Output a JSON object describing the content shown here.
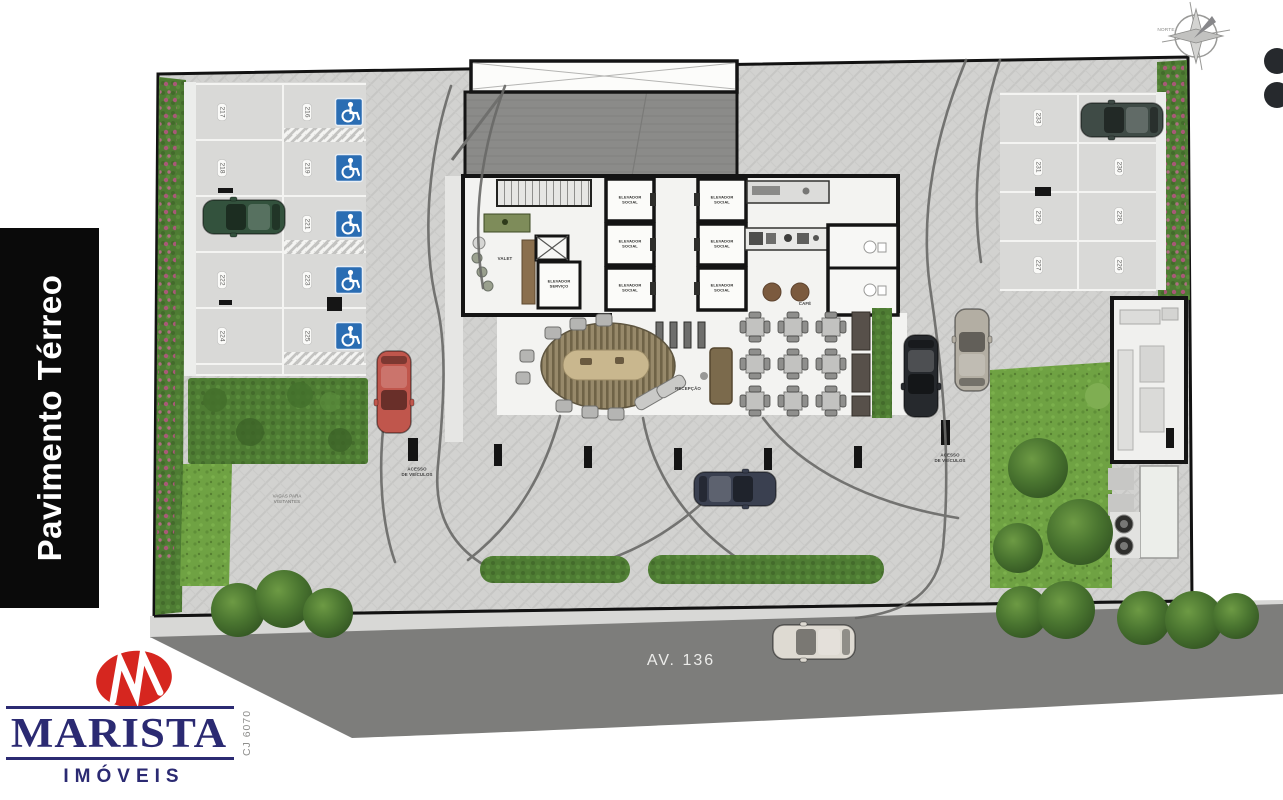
{
  "sidebar": {
    "floor_label": "Pavimento Térreo"
  },
  "brand": {
    "name": "MARISTA",
    "subtitle": "IMÓVEIS",
    "registry": "CJ 6070"
  },
  "compass": {
    "north_label": "NORTE"
  },
  "street": {
    "name": "AV. 136"
  },
  "palette": {
    "accessible_blue": "#2a6db3",
    "brand_navy": "#2b2a72",
    "brand_red": "#d6261f",
    "lawn_green": "#6fa243",
    "road_gray": "#7d7d7b"
  },
  "plan": {
    "left_parking": {
      "col_a": [
        "217",
        "218",
        "222",
        "224"
      ],
      "col_b": [
        "216",
        "219",
        "221",
        "223",
        "225"
      ]
    },
    "right_parking": {
      "col_a": [
        "233",
        "231",
        "229",
        "227"
      ],
      "col_b": [
        "230",
        "228",
        "226"
      ]
    },
    "rooms": {
      "valet": "VALET",
      "social_elevator_line1": "ELEVADOR",
      "social_elevator_line2": "SOCIAL",
      "service_elevator_line1": "ELEVADOR",
      "service_elevator_line2": "SERVIÇO",
      "cafe": "CAFÉ",
      "reception": "RECEPÇÃO"
    },
    "annotations": {
      "access_line1": "ACESSO",
      "access_line2": "DE VEÍCULOS",
      "visitor_line1": "VAGAS PARA",
      "visitor_line2": "VISITANTES"
    }
  }
}
